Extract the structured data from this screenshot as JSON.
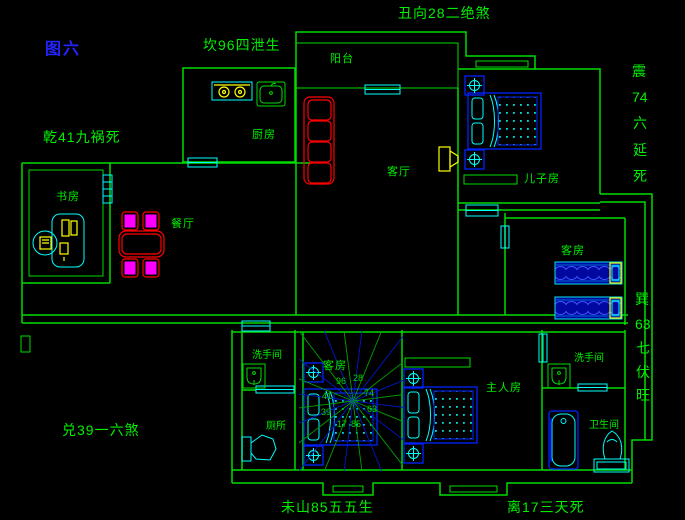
{
  "figure": {
    "label": "图六"
  },
  "annotations": {
    "top": "丑向28二绝煞",
    "north": "坎96四泄生",
    "northwest": "乾41九祸死",
    "east": {
      "chars": [
        "震",
        "74",
        "六",
        "延",
        "死"
      ]
    },
    "southeast": {
      "chars": [
        "巽",
        "63",
        "七",
        "伏",
        "旺"
      ]
    },
    "west": "兑39一六煞",
    "southwest": "未山85五五生",
    "south": "离17三天死"
  },
  "rooms": {
    "balcony": "阳台",
    "kitchen": "厨房",
    "living_room": "客厅",
    "son_room": "儿子房",
    "study": "书房",
    "dining": "餐厅",
    "guest_room_east": "客房",
    "guest_room_center": "客房",
    "washroom_left": "洗手间",
    "toilet": "厕所",
    "master_room": "主人房",
    "washroom_right": "洗手间",
    "bathroom": "卫生间"
  },
  "compass": {
    "numbers": [
      "96",
      "28",
      "74",
      "41",
      "63",
      "39",
      "17",
      "85"
    ]
  },
  "colors": {
    "background": "#000000",
    "wall_green": "#00dc00",
    "text_green": "#00f000",
    "window_cyan": "#00ffff",
    "bed_blue": "#0022ff",
    "figure_blue": "#2323ff",
    "table_red": "#ff0000",
    "chair_magenta": "#ff00ff",
    "appliance_yellow": "#ffff00"
  }
}
